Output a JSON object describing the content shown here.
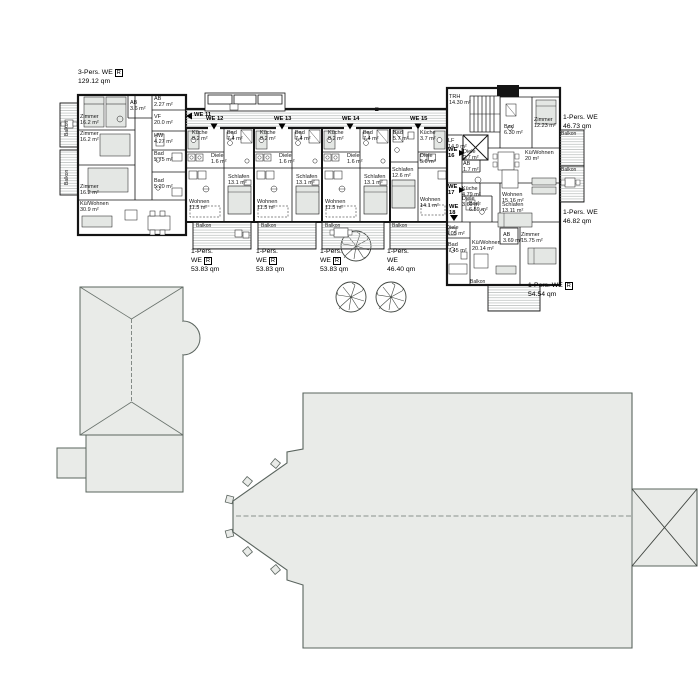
{
  "drawing": {
    "type": "architectural-floor-plan",
    "language": "de"
  },
  "colors": {
    "wall": "#141414",
    "roof_fill": "#e9ebe8",
    "roof_stroke": "#5a645e",
    "hatch": "#b7bbb9",
    "furniture": "#e4e7e4"
  },
  "icons": {
    "tree": "deciduous-tree-icon",
    "elevator": "elevator-icon",
    "stairs": "stairs-icon",
    "door_arrow": "door-swing-icon",
    "wheelchair": "wheelchair-icon"
  },
  "units": {
    "we11": "WE 11",
    "we12": "WE 12",
    "we13": "WE 13",
    "we14": "WE 14",
    "we15": "WE 15",
    "we16": "WE\n16",
    "we17": "WE\n17",
    "we18": "WE\n18"
  },
  "summaries": {
    "we11": {
      "l1": "3-Pers. WE",
      "flag": "R",
      "l2": "129.12 qm"
    },
    "colA": {
      "l1": "1-Pers.",
      "l2": "WE",
      "flag": "R",
      "l3": "53.83 qm"
    },
    "we15": {
      "l1": "1-Pers.",
      "l2": "WE",
      "l3": "46.40 qm"
    },
    "we16": {
      "l1": "1-Pers. WE",
      "l2": "46.73 qm"
    },
    "we17": {
      "l1": "1-Pers. WE",
      "l2": "46.82 qm"
    },
    "we18": {
      "l1": "1-Pers. WE",
      "flag": "R",
      "l2": "54.54 qm"
    }
  },
  "rooms": {
    "we11": [
      "Zimmer\n16.2 m²",
      "Zimmer\n16.2 m²",
      "Zimmer\n16.2 m²",
      "Kü/Wohnen\n30.9 m²",
      "AB\n3.6 m²",
      "AB\n2.27 m²",
      "VF\n20.0 m²",
      "HW\n4.27 m²",
      "Bad\n5.75 m²",
      "Bad\n5.20 m²"
    ],
    "typeA": [
      "Küche\n8.2 m²",
      "Bad\n7.4 m²",
      "Diele\n1.6 m²",
      "Schlafen\n13.1 m²",
      "Wohnen\n11.5 m²"
    ],
    "we15": [
      "Bad\n5.7 m²",
      "Küche\n3.7 m²",
      "Diele\n5.0 m²",
      "Schlafen\n12.6 m²",
      "Wohnen\n14.1 m²"
    ],
    "wing": {
      "trh": "TRH\n14.30 m²",
      "lf": "LF\n14.9 m²"
    },
    "we16": [
      "Bad\n6.30 m²",
      "Zimmer\n12.23 m²",
      "Kü/Wohnen\n20 m²",
      "Diele\n2.7 m²",
      "AB\n1.7 m²"
    ],
    "we17": [
      "Küche\n4.79 m²",
      "Diele\n3.69 m²",
      "Bad\n6.59 m²",
      "Wohnen\n15.16 m²",
      "Schlafen\n13.11 m²"
    ],
    "we18": [
      "Diele\n4.05 m²",
      "Bad\n7.45 m²",
      "Kü/Wohnen\n20.14 m²",
      "AB\n3.69 m²",
      "Zimmer\n15.75 m²"
    ]
  },
  "labels": {
    "balkon": "Balkon"
  }
}
